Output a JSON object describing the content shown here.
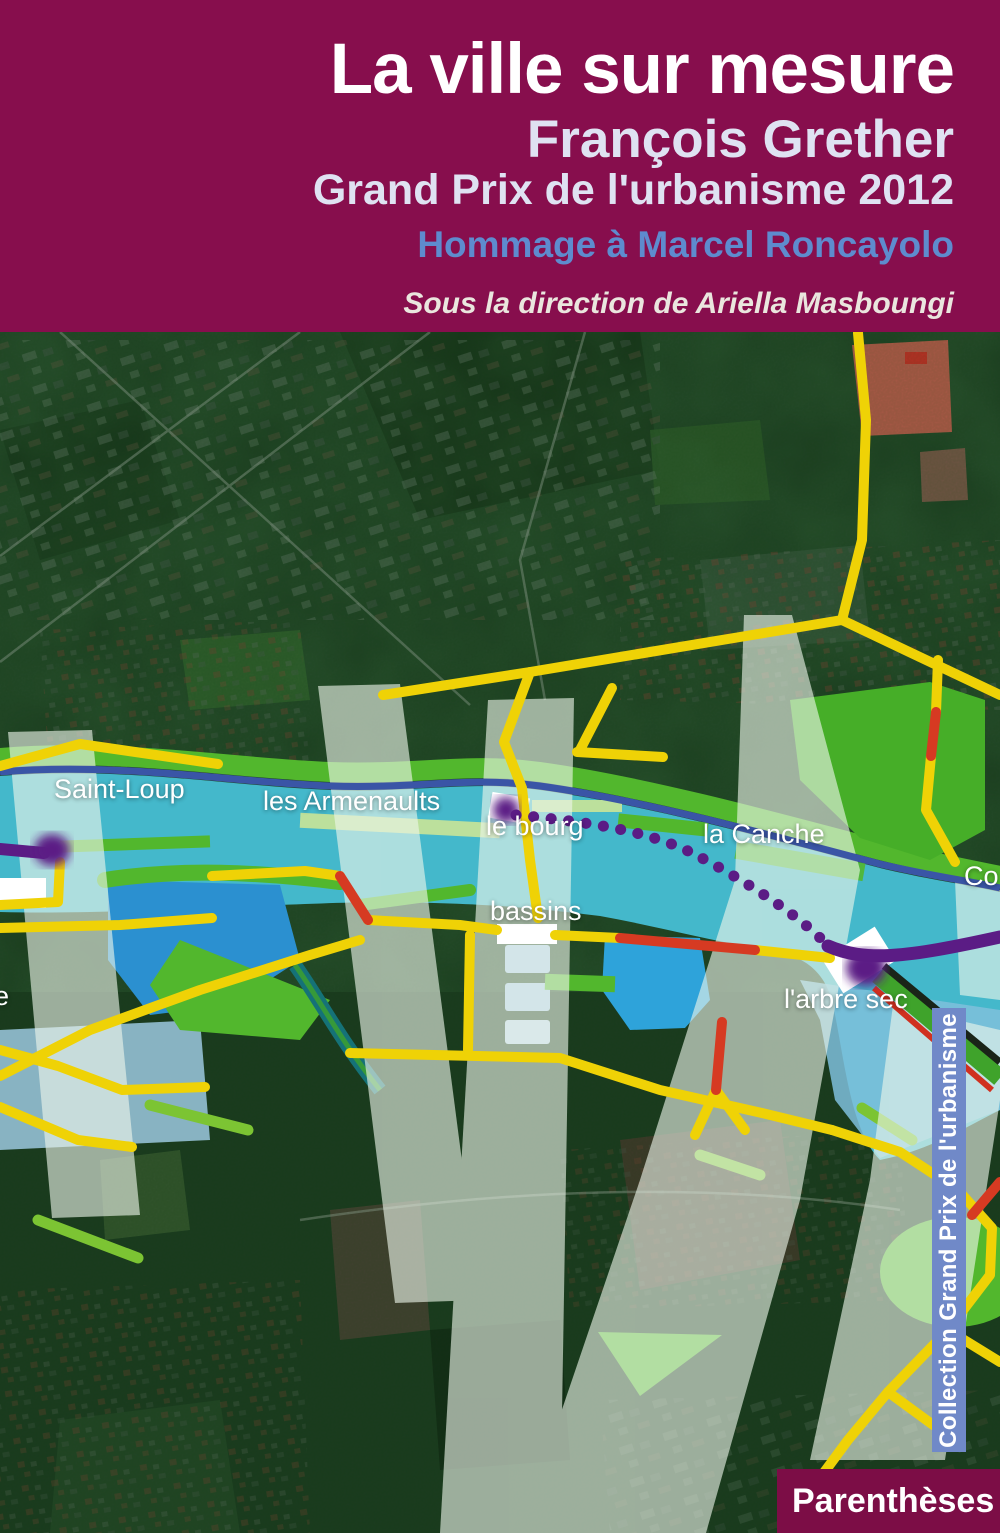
{
  "cover": {
    "title": "La ville sur mesure",
    "author": "François Grether",
    "subtitle": "Grand Prix de l'urbanisme 2012",
    "homage": "Hommage à Marcel Roncayolo",
    "direction": "Sous la direction de Ariella Masboungi",
    "collection": "Collection Grand Prix de l'urbanisme",
    "publisher": "Parenthèses"
  },
  "map_labels": {
    "saint_loup": "Saint-Loup",
    "les_armenaults": "les Armenaults",
    "le_bourg": "le bourg",
    "la_canche": "la Canche",
    "bassins": "bassins",
    "arbre_sec": "l'arbre sec",
    "partial_right": "Co",
    "partial_left": "e"
  },
  "colors": {
    "header_bg": "#870E4D",
    "publisher_bg": "#7C0D46",
    "collection_strip_bg": "#7089C8",
    "homage_text": "#5E8BCE",
    "subtitle_text": "#DFE2F2",
    "river": "#44B8CB",
    "lake": "#2EA3DA",
    "bright_green": "#52B72D",
    "pale_band": "#EDF6EA",
    "road_yellow": "#EFD206",
    "road_red": "#D63A22",
    "route_purple": "#5B1C85",
    "channel_blue": "#3A55A6"
  }
}
